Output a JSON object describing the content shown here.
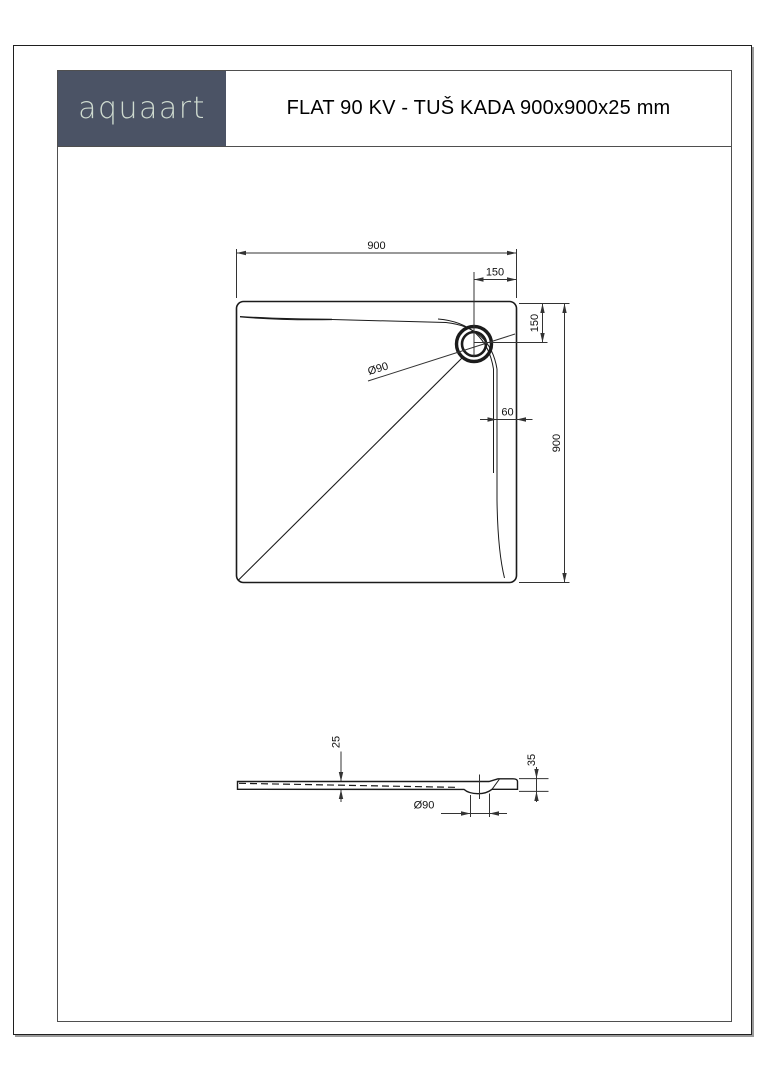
{
  "header": {
    "logo_text": "aquaart",
    "title": "FLAT 90 KV - TUŠ KADA 900x900x25 mm"
  },
  "colors": {
    "logo_bg": "#4b5365",
    "logo_text": "#cfdbd0",
    "outline": "#1b1b1b",
    "dim_line": "#333333"
  },
  "top_view": {
    "dim_width": "900",
    "dim_height": "900",
    "dim_drain_offset_top": "150",
    "dim_drain_offset_right": "150",
    "dim_rim_width": "60",
    "drain_diameter": "Ø90"
  },
  "side_view": {
    "dim_thickness": "25",
    "dim_total_height": "35",
    "drain_diameter": "Ø90"
  }
}
